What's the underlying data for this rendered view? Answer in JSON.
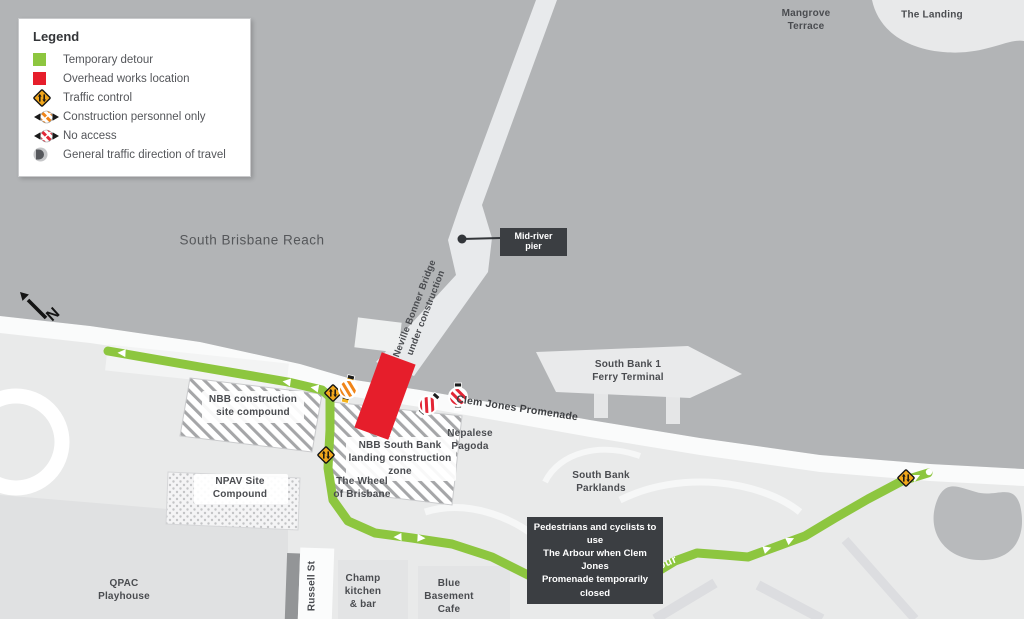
{
  "colors": {
    "temporary_detour_green": "#8dc63f",
    "overhead_works_red": "#e61e2b",
    "traffic_control_yellow": "#f2a71b",
    "river_gray": "#b2b4b6",
    "land_gray": "#e9eaea",
    "callout_dark": "#3b3e42",
    "label_gray": "#4a4c50"
  },
  "legend": {
    "title": "Legend",
    "items": [
      {
        "icon": "temporary-detour-swatch",
        "label": "Temporary detour"
      },
      {
        "icon": "overhead-works-swatch",
        "label": "Overhead works location"
      },
      {
        "icon": "traffic-control-icon",
        "label": "Traffic control"
      },
      {
        "icon": "construction-personnel-only-icon",
        "label": "Construction personnel only"
      },
      {
        "icon": "no-access-icon",
        "label": "No access"
      },
      {
        "icon": "direction-of-travel-icon",
        "label": "General traffic direction of travel"
      }
    ]
  },
  "icons": {
    "temporary-detour-swatch": "green square",
    "overhead-works-swatch": "red square",
    "traffic-control-icon": "yellow diamond sign with two-way arrows",
    "construction-personnel-only-icon": "orange striped no-entry circle over barrier tape",
    "no-access-icon": "red striped no-entry circle over barrier tape",
    "direction-of-travel-icon": "gray circle with dark half-disc arrow",
    "north-arrow": "black arrow pointing north-west with letter N",
    "direction-arrow": "white triangle arrow on detour path"
  },
  "map": {
    "north_indicator": {
      "label": "N"
    },
    "labels": {
      "south_brisbane_reach": "South Brisbane Reach",
      "mangrove_terrace": "Mangrove\nTerrace",
      "the_landing": "The Landing",
      "bridge": "Neville Bonner Bridge\nunder construction",
      "clem_jones": "Clem Jones Promenade",
      "ferry_terminal": "South Bank 1\nFerry Terminal",
      "nbb_compound": "NBB construction\nsite compound",
      "nbb_landing_zone": "NBB South Bank\nlanding construction\nzone",
      "nepalese_pagoda": "Nepalese\nPagoda",
      "npav": "NPAV Site\nCompound",
      "wheel": "The Wheel\nof Brisbane",
      "parklands": "South Bank\nParklands",
      "qpac": "QPAC\nPlayhouse",
      "russell_st": "Russell St",
      "champ": "Champ\nkitchen\n& bar",
      "blue_basement": "Blue\nBasement\nCafe",
      "arbour": "The Arbour"
    },
    "callouts": {
      "mid_river_pier": "Mid-river pier",
      "arbour_note": "Pedestrians and cyclists to use\nThe Arbour when Clem Jones\nPromenade temporarily closed"
    },
    "markers": [
      {
        "type": "traffic-control",
        "x": 333,
        "y": 393
      },
      {
        "type": "traffic-control",
        "x": 326,
        "y": 455
      },
      {
        "type": "traffic-control",
        "x": 906,
        "y": 478
      },
      {
        "type": "construction-personnel-only",
        "x": 348,
        "y": 389
      },
      {
        "type": "no-access",
        "x": 428,
        "y": 405
      },
      {
        "type": "no-access",
        "x": 458,
        "y": 397
      },
      {
        "type": "mid-river-pier-dot",
        "x": 462,
        "y": 239
      },
      {
        "type": "arbour-note-dot",
        "x": 572,
        "y": 596
      }
    ]
  }
}
